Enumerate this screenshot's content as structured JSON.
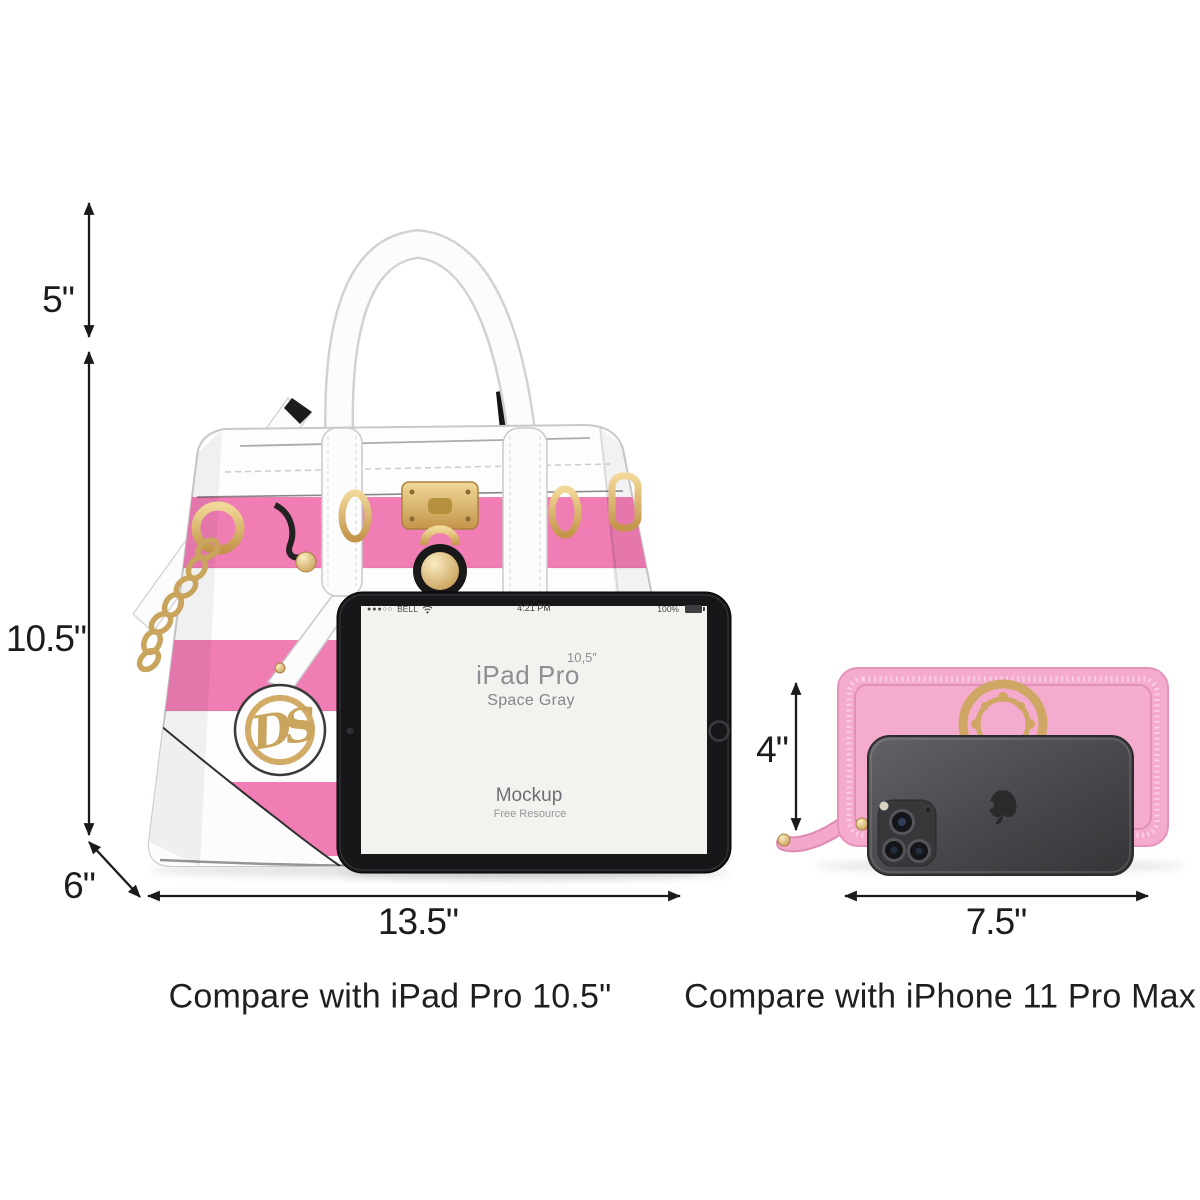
{
  "page": {
    "width": 1200,
    "height": 1200,
    "background": "#ffffff"
  },
  "dimensions": {
    "handle_height": "5\"",
    "bag_height": "10.5\"",
    "bag_depth": "6\"",
    "bag_width": "13.5\"",
    "wallet_height": "4\"",
    "wallet_width": "7.5\""
  },
  "captions": {
    "compare_ipad": "Compare with iPad Pro 10.5\"",
    "compare_iphone": "Compare with iPhone 11 Pro Max"
  },
  "ipad_screen": {
    "status_signal": "●●●○○",
    "status_carrier": "BELL",
    "status_time": "4:21 PM",
    "status_battery_percent": "100%",
    "title": "iPad Pro",
    "title_size_superscript": "10,5″",
    "subtitle": "Space Gray",
    "center_heading": "Mockup",
    "center_subheading": "Free Resource"
  },
  "handbag": {
    "charm_monogram": "DS"
  },
  "colors": {
    "stripe_pink": "#f07db4",
    "wallet_pink": "#f4abce",
    "gold": "#d2ab67",
    "iphone_gray": "#48484c",
    "annotation": "#1a1a1a"
  }
}
